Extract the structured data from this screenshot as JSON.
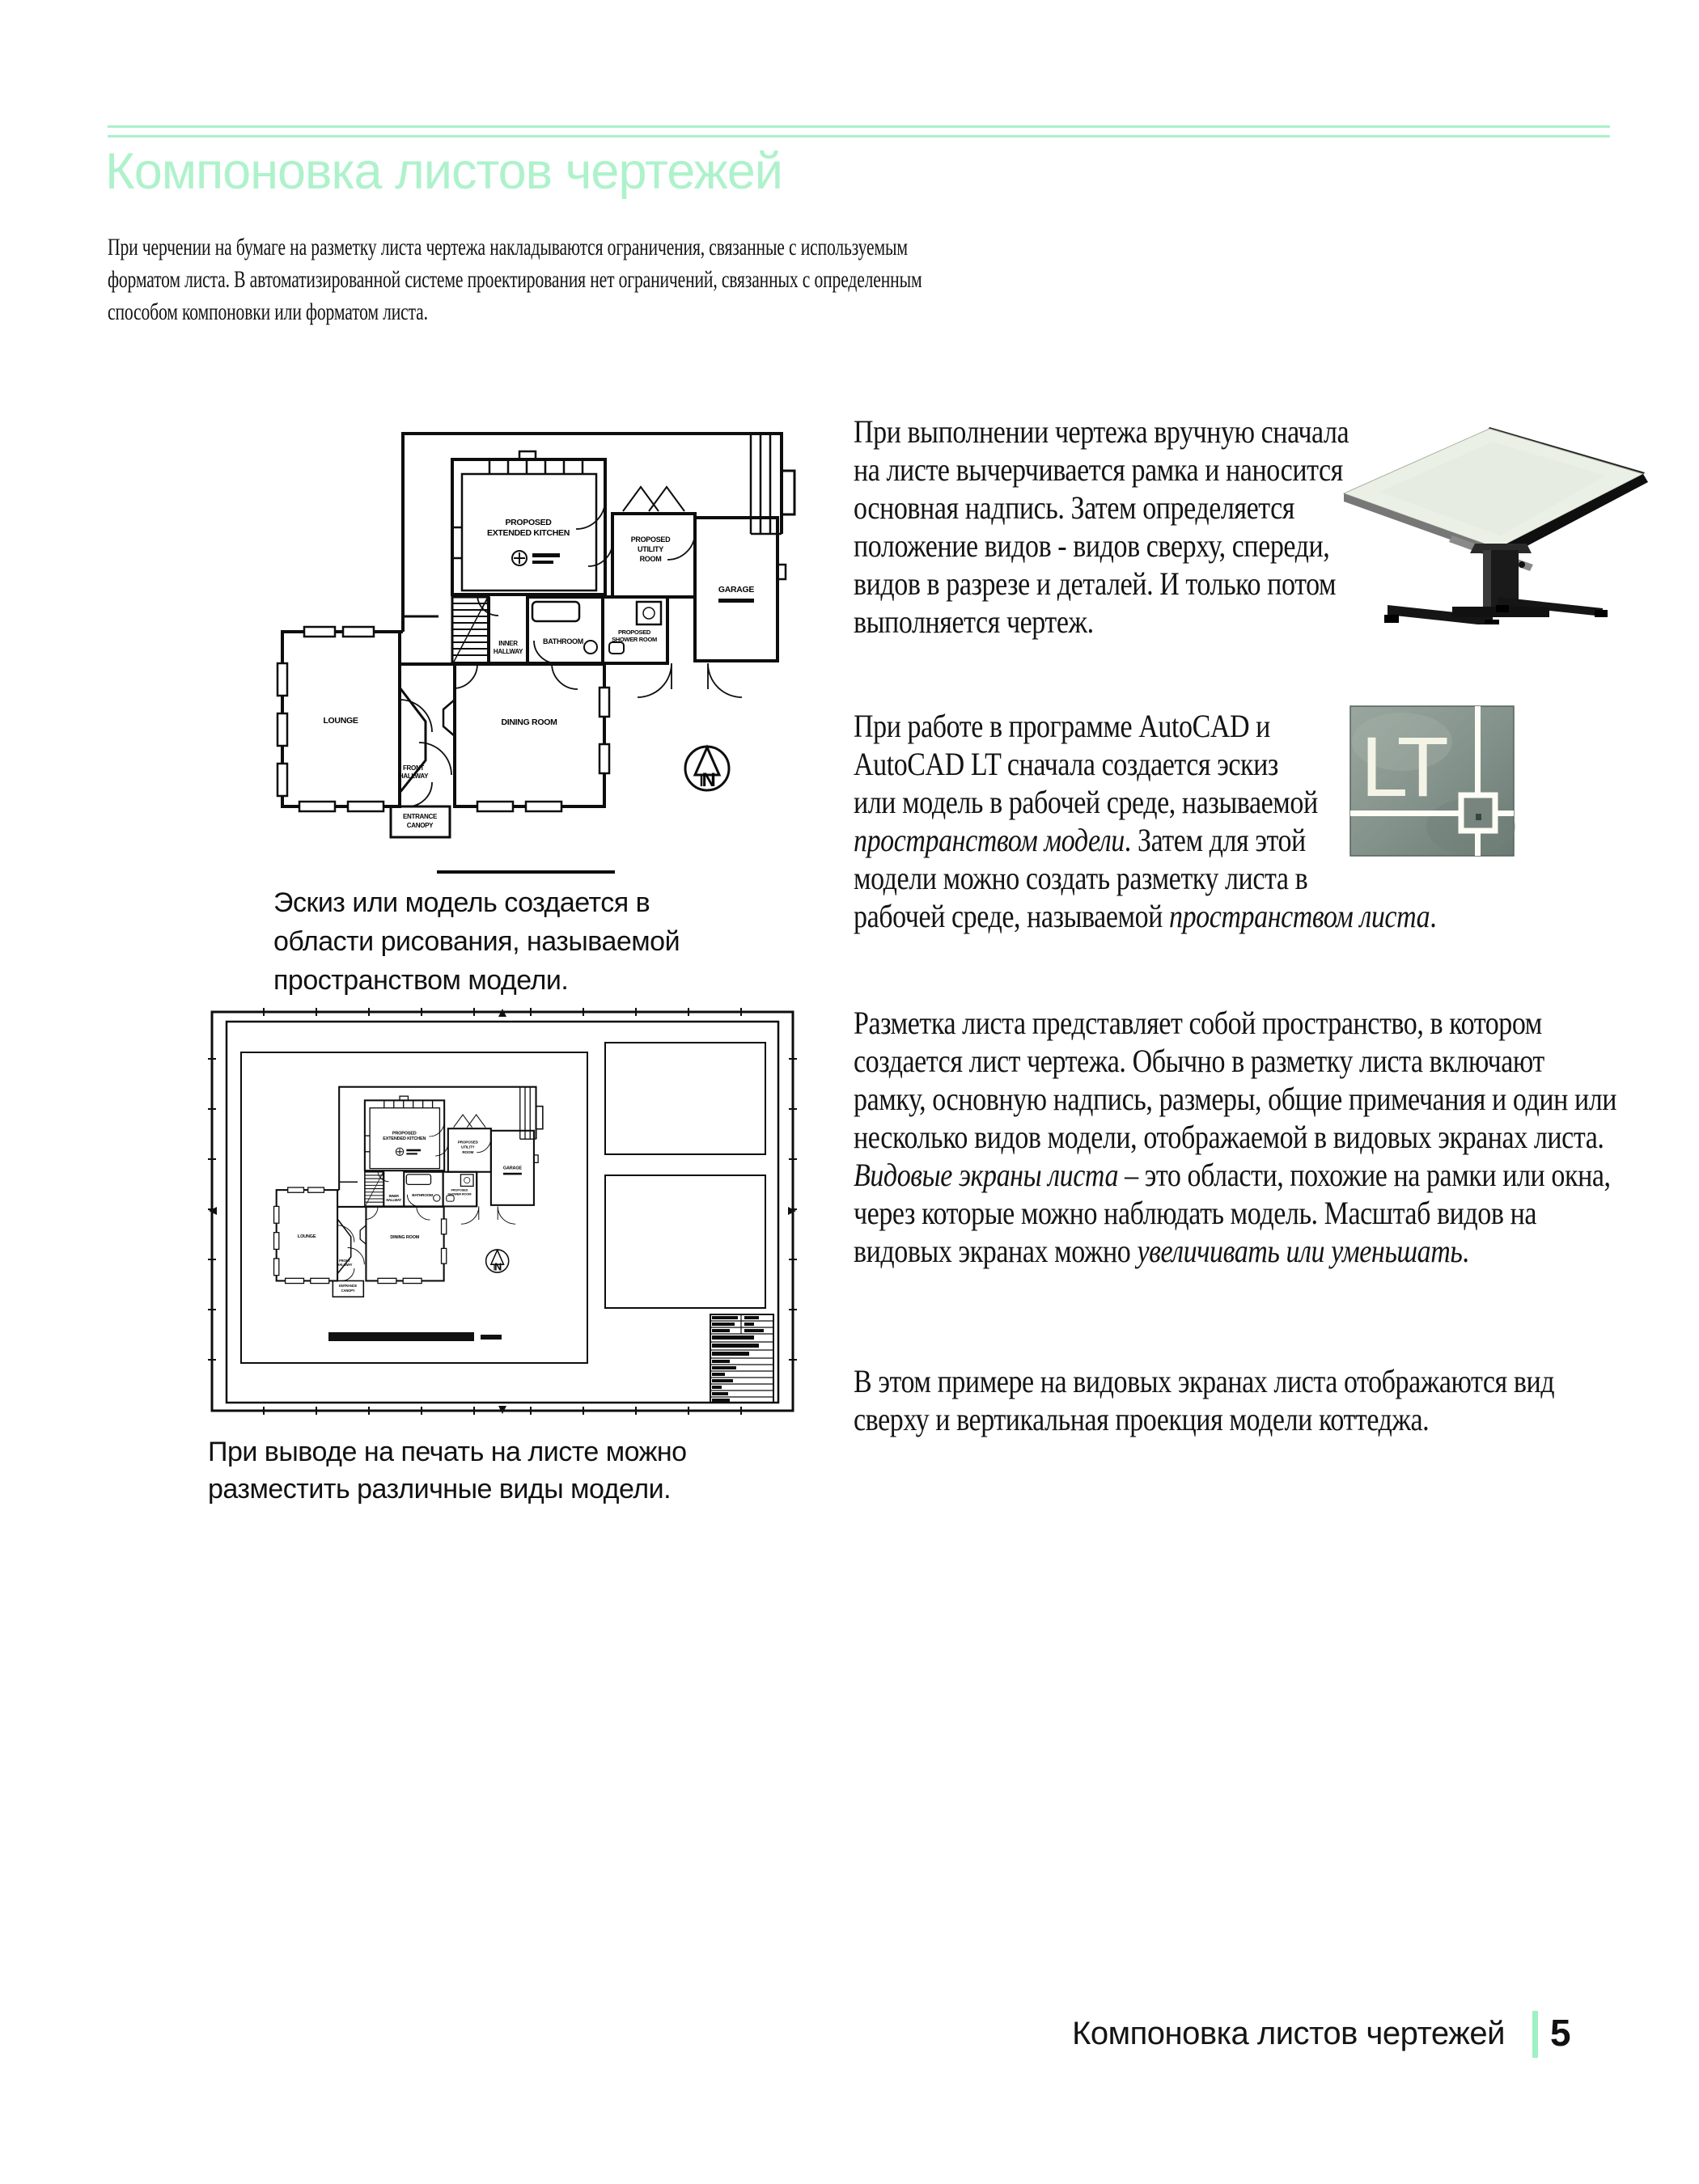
{
  "colors": {
    "accent_mint": "#a9f1c9",
    "text": "#141414",
    "drawing_ink": "#0d0d0d",
    "lt_badge_bg": "#86948d"
  },
  "header": {
    "title": "Компоновка листов чертежей"
  },
  "intro": "При черчении на бумаге на разметку листа чертежа накладываются ограничения, связанные с используемым форматом листа. В автоматизированной системе проектирования нет ограничений, связанных с определенным способом компоновки или форматом листа.",
  "body": {
    "p1": "При выполнении чертежа вручную сначала на листе вычерчивается рамка и наносится основная надпись. Затем определяется положение видов - видов сверху, спереди, видов в разрезе и деталей. И только потом выполняется чертеж.",
    "p2": {
      "t1": "При работе в программе AutoCAD и AutoCAD LT сначала создается эскиз или модель в рабочей среде, называемой ",
      "i1": "пространством модели",
      "t2": ". Затем для этой модели можно создать разметку листа в рабочей среде, называемой ",
      "i2": "пространством листа",
      "t3": "."
    },
    "p3": {
      "t1": "Разметка листа представляет собой пространство, в котором создается лист чертежа. Обычно в разметку листа включают рамку, основную надпись, размеры, общие примечания и один или несколько видов модели, отображаемой в видовых экранах листа. ",
      "i1": "Видовые экраны листа",
      "t2": " – это области, похожие на рамки или окна, через которые можно наблюдать модель. Масштаб видов на видовых экранах можно ",
      "i2": "увеличивать или уменьшать",
      "t3": "."
    },
    "p4": "В этом примере на видовых экранах листа отображаются вид сверху и вертикальная проекция модели коттеджа."
  },
  "figures": {
    "model_space_caption": "Эскиз или модель создается в области рисования, называемой пространством модели.",
    "layout_caption": "При выводе на печать на листе можно разместить различные виды модели."
  },
  "floor_plan": {
    "labels": {
      "kitchen_line1": "PROPOSED",
      "kitchen_line2": "EXTENDED KITCHEN",
      "utility_line1": "PROPOSED",
      "utility_line2": "UTILITY",
      "utility_line3": "ROOM",
      "garage": "GARAGE",
      "bathroom": "BATHROOM",
      "inner_hallway_line1": "INNER",
      "inner_hallway_line2": "HALLWAY",
      "shower_line1": "PROPOSED",
      "shower_line2": "SHOWER ROOM",
      "lounge": "LOUNGE",
      "dining_room": "DINING ROOM",
      "front_hallway_line1": "FRONT",
      "front_hallway_line2": "HALLWAY",
      "canopy_line1": "ENTRANCE",
      "canopy_line2": "CANOPY",
      "north": "N"
    }
  },
  "lt_badge": {
    "label": "LT"
  },
  "footer": {
    "section": "Компоновка листов чертежей",
    "page_number": "5"
  }
}
